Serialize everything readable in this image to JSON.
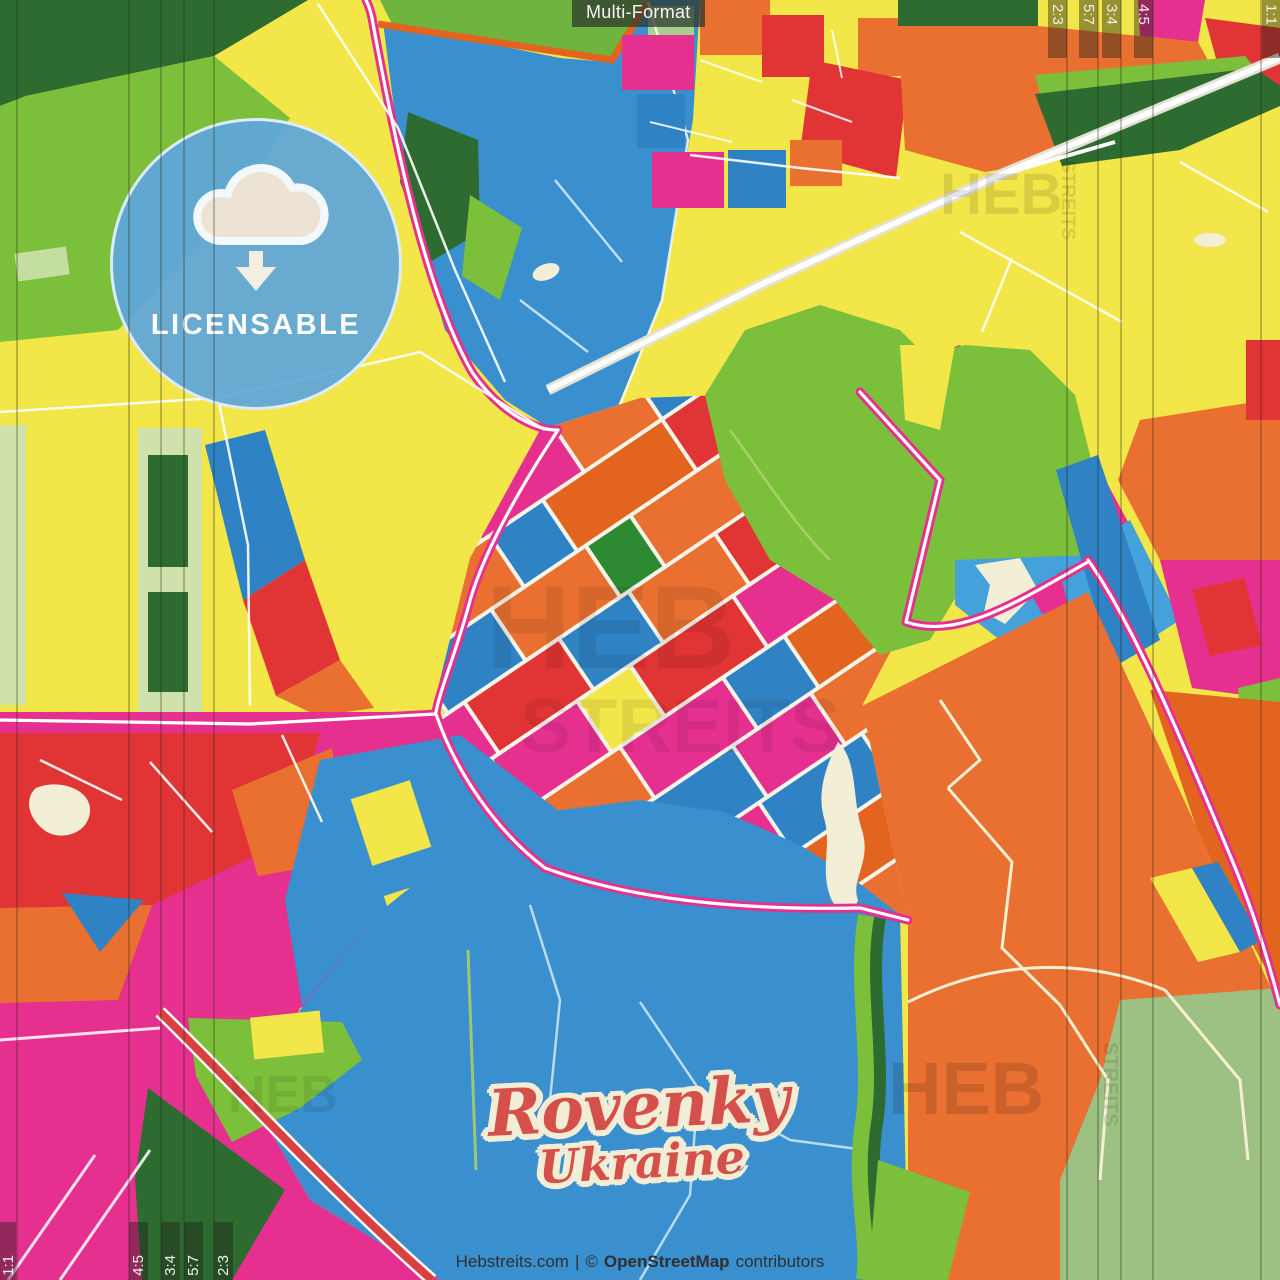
{
  "badges": {
    "format_label": "Multi-Format",
    "license_label": "LICENSABLE"
  },
  "logo": {
    "title": "Rovenky",
    "subtitle": "Ukraine"
  },
  "footer": {
    "site": "Hebstreits.com",
    "separator": "|",
    "copyright_symbol": "©",
    "osm": "OpenStreetMap",
    "contributors": "contributors"
  },
  "crop_marks": {
    "top_right": [
      {
        "label": "2:3"
      },
      {
        "label": "5:7"
      },
      {
        "label": "3:4"
      },
      {
        "label": "4:5"
      },
      {
        "label": "1:1"
      }
    ],
    "bottom_left": [
      {
        "label": "1:1"
      },
      {
        "label": "4:5"
      },
      {
        "label": "3:4"
      },
      {
        "label": "5:7"
      },
      {
        "label": "2:3"
      }
    ]
  },
  "watermarks": {
    "brand_top": "HEB",
    "street_top": "STREITS",
    "brand_center_line1": "HEB",
    "brand_center_line2": "STREITS",
    "brand_bottom": "HEB",
    "street_bottom": "STREITS",
    "brand_bottom_left": "HEB"
  },
  "palette": {
    "yellow": "#f2e648",
    "magenta": "#e5308f",
    "orange": "#e97031",
    "dark_orange": "#e2641f",
    "red": "#e13434",
    "blue": "#2f82c4",
    "light_blue": "#45a1d9",
    "water_blue": "#3a8fce",
    "green": "#7cbf3b",
    "dark_green": "#2d6b30",
    "sage": "#9dc183",
    "cream": "#f3eed6",
    "road_white": "#ffffff",
    "badge_blue": "#5da6dc",
    "logo_red": "#d5504a"
  }
}
